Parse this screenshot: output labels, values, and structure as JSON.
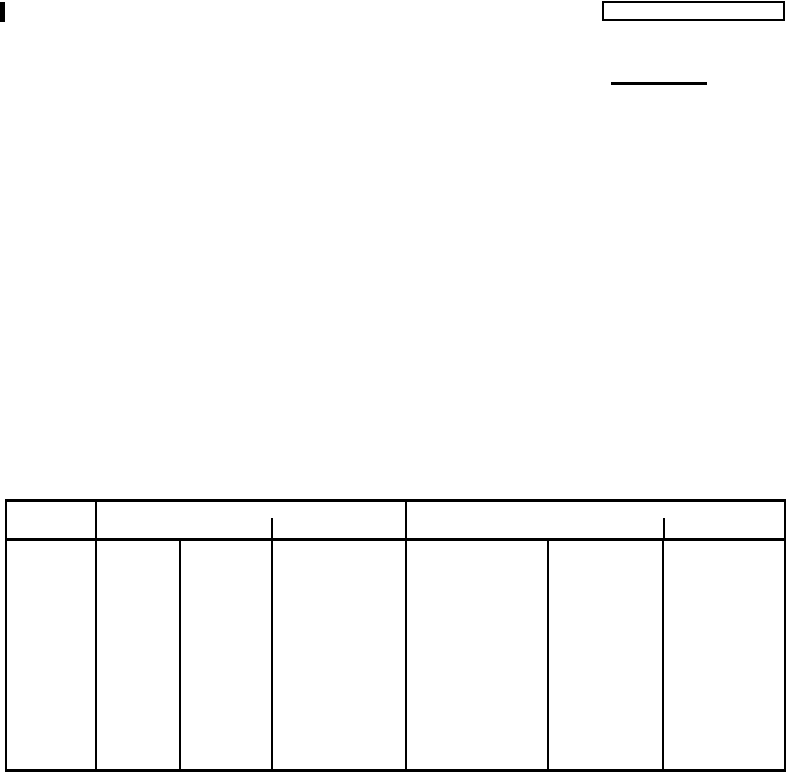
{
  "page": {
    "background_color": "#ffffff",
    "line_color": "#000000"
  },
  "top_left_mark": {
    "type": "filled-rectangle"
  },
  "top_right_box": {
    "value": ""
  },
  "underline_field": {
    "value": ""
  },
  "form_table": {
    "header_cells": [
      {
        "label": ""
      },
      {
        "label": ""
      },
      {
        "label": ""
      }
    ],
    "body_cells": [
      {
        "value": ""
      },
      {
        "value": ""
      },
      {
        "value": ""
      },
      {
        "value": ""
      },
      {
        "value": ""
      },
      {
        "value": ""
      },
      {
        "value": ""
      }
    ]
  }
}
